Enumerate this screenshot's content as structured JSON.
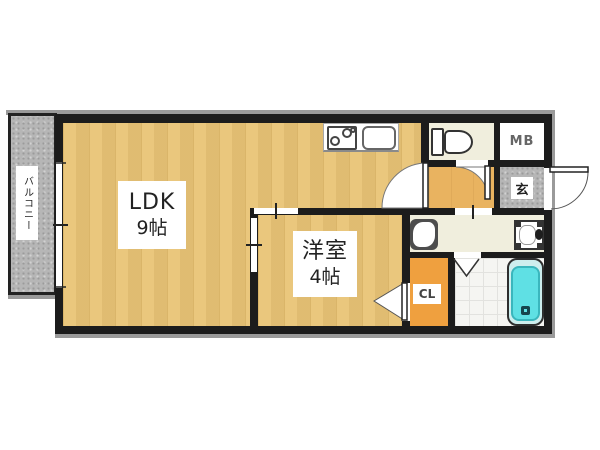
{
  "floorplan": {
    "balcony": {
      "name": "バルコニー"
    },
    "ldk": {
      "name": "LDK",
      "size": "9帖"
    },
    "western_room": {
      "name": "洋室",
      "size": "4帖"
    },
    "closet": {
      "name": "CL"
    },
    "meter_box": {
      "name": "MB"
    },
    "entrance": {
      "name": "玄"
    },
    "fixtures": [
      "stove",
      "kitchen-sink",
      "toilet",
      "washing-machine",
      "washbasin",
      "bathtub",
      "bifold-bath-door"
    ],
    "colors": {
      "wall": "#1c1c1c",
      "wood_floor": "#e9c476",
      "hall_floor": "#e9b360",
      "closet_orange": "#efa03f",
      "service_floor": "#f0eedd",
      "tile_gray": "#b6b6b6",
      "bath_floor": "#f5f5f2",
      "bathtub_cyan": "#5fe0e4",
      "background": "#ffffff"
    }
  }
}
